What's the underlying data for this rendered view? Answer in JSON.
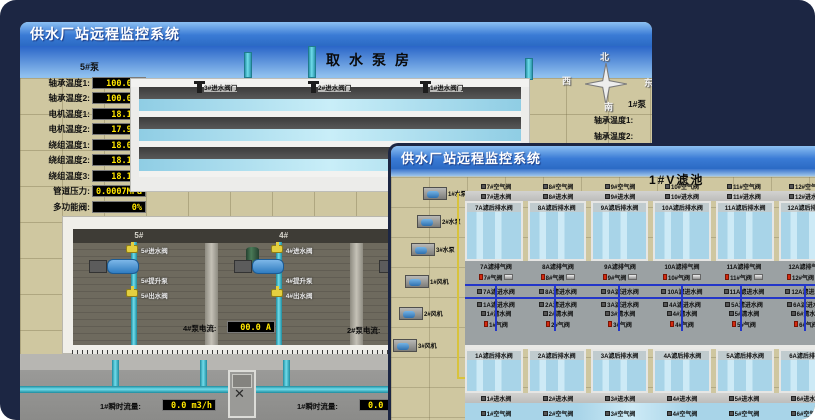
{
  "colors": {
    "canvas_bg": "#1c2643",
    "titlebar_blue": "#3a7bd5",
    "value_yellow": "#ffe600",
    "alarm_red": "#d42a10",
    "pipe_cyan": "#49c2d4",
    "water_blue": "#a8d4e8"
  },
  "window1": {
    "title": "供水厂站远程监控系统",
    "scene_title": "取水泵房",
    "panel": {
      "header": "5#泵",
      "rows": [
        {
          "label": "轴承温度1:",
          "value": "100.0°C"
        },
        {
          "label": "轴承温度2:",
          "value": "100.0°C"
        },
        {
          "label": "电机温度1:",
          "value": "18.1°C"
        },
        {
          "label": "电机温度2:",
          "value": "17.9°C"
        },
        {
          "label": "绕组温度1:",
          "value": "18.0°C"
        },
        {
          "label": "绕组温度2:",
          "value": "18.1°C"
        },
        {
          "label": "绕组温度3:",
          "value": "18.1°C"
        },
        {
          "label": "管道压力:",
          "value": "0.0007MPa"
        },
        {
          "label": "多功能阀:",
          "value": "0%"
        }
      ]
    },
    "intake_valves": [
      {
        "label": "3#进水阀门"
      },
      {
        "label": "2#进水阀门"
      },
      {
        "label": "1#进水阀门"
      }
    ],
    "compass": {
      "north": "北",
      "west": "西",
      "south": "南",
      "east": "东"
    },
    "right_panel": {
      "header": "1#泵",
      "labels": [
        "轴承温度1:",
        "轴承温度2:"
      ]
    },
    "bays": [
      {
        "no": "5#",
        "valve_in": "5#进水阀",
        "pump": "5#提升泵",
        "valve_out": "5#出水阀"
      },
      {
        "no": "4#",
        "valve_in": "4#进水阀",
        "pump": "4#提升泵",
        "valve_out": "4#出水阀"
      },
      {
        "no": "3#",
        "valve_in": "3#进水阀",
        "pump": "3#提升泵",
        "valve_out": "3#出水阀"
      },
      {
        "no": "2#",
        "valve_in": "2#进水阀",
        "pump": "2#提升泵",
        "valve_out": "2#出水阀"
      }
    ],
    "currents": [
      {
        "label": "4#泵电流:",
        "value": "00.0 A"
      },
      {
        "label": "2#泵电流:",
        "value": ""
      }
    ],
    "flows": [
      {
        "label": "1#瞬时流量:",
        "value": "0.0 m3/h"
      },
      {
        "label": "1#瞬时流量:",
        "value": "0.0 m3/h"
      }
    ]
  },
  "window2": {
    "title": "供水厂站远程监控系统",
    "scene_title": "1#V滤池",
    "equipment": [
      {
        "label": "1#水泵"
      },
      {
        "label": "2#水泵"
      },
      {
        "label": "3#水泵"
      },
      {
        "label": "1#风机"
      },
      {
        "label": "2#风机"
      },
      {
        "label": "3#风机"
      }
    ],
    "top_bank": [
      {
        "air": "7#空气阀",
        "water": "7#进水阀",
        "drain": "7A滤后排水阀"
      },
      {
        "air": "8#空气阀",
        "water": "8#进水阀",
        "drain": "8A滤后排水阀"
      },
      {
        "air": "9#空气阀",
        "water": "9#进水阀",
        "drain": "9A滤后排水阀"
      },
      {
        "air": "10#空气阀",
        "water": "10#进水阀",
        "drain": "10A滤后排水阀"
      },
      {
        "air": "11#空气阀",
        "water": "11#进水阀",
        "drain": "11A滤后排水阀"
      },
      {
        "air": "12#空气阀",
        "water": "12#进水阀",
        "drain": "12A滤后排水阀"
      }
    ],
    "corridor_top": [
      {
        "exhaust": "7A滤排气阀",
        "gas": "7#气阀",
        "inlet": "7A滤进水阀"
      },
      {
        "exhaust": "8A滤排气阀",
        "gas": "8#气阀",
        "inlet": "8A滤进水阀"
      },
      {
        "exhaust": "9A滤排气阀",
        "gas": "9#气阀",
        "inlet": "9A滤进水阀"
      },
      {
        "exhaust": "10A滤排气阀",
        "gas": "10#气阀",
        "inlet": "10A滤进水阀"
      },
      {
        "exhaust": "11A滤排气阀",
        "gas": "11#气阀",
        "inlet": "11A滤进水阀"
      },
      {
        "exhaust": "12A滤排气阀",
        "gas": "12#气阀",
        "inlet": "12A滤进水阀"
      }
    ],
    "corridor_bottom": [
      {
        "inlet": "1A滤进水阀",
        "clean": "1#清水阀",
        "gas": "1#气阀"
      },
      {
        "inlet": "2A滤进水阀",
        "clean": "2#清水阀",
        "gas": "2#气阀"
      },
      {
        "inlet": "3A滤进水阀",
        "clean": "3#清水阀",
        "gas": "3#气阀"
      },
      {
        "inlet": "4A滤进水阀",
        "clean": "4#清水阀",
        "gas": "4#气阀"
      },
      {
        "inlet": "5A滤进水阀",
        "clean": "5#清水阀",
        "gas": "5#气阀"
      },
      {
        "inlet": "6A滤进水阀",
        "clean": "6#清水阀",
        "gas": "6#气阀"
      }
    ],
    "bottom_bank": [
      {
        "drain": "1A滤后排水阀",
        "water": "1#进水阀",
        "air": "1#空气阀"
      },
      {
        "drain": "2A滤后排水阀",
        "water": "2#进水阀",
        "air": "2#空气阀"
      },
      {
        "drain": "3A滤后排水阀",
        "water": "3#进水阀",
        "air": "3#空气阀"
      },
      {
        "drain": "4A滤后排水阀",
        "water": "4#进水阀",
        "air": "4#空气阀"
      },
      {
        "drain": "5A滤后排水阀",
        "water": "5#进水阀",
        "air": "5#空气阀"
      },
      {
        "drain": "6A滤后排水阀",
        "water": "6#进水阀",
        "air": "6#空气阀"
      }
    ]
  }
}
